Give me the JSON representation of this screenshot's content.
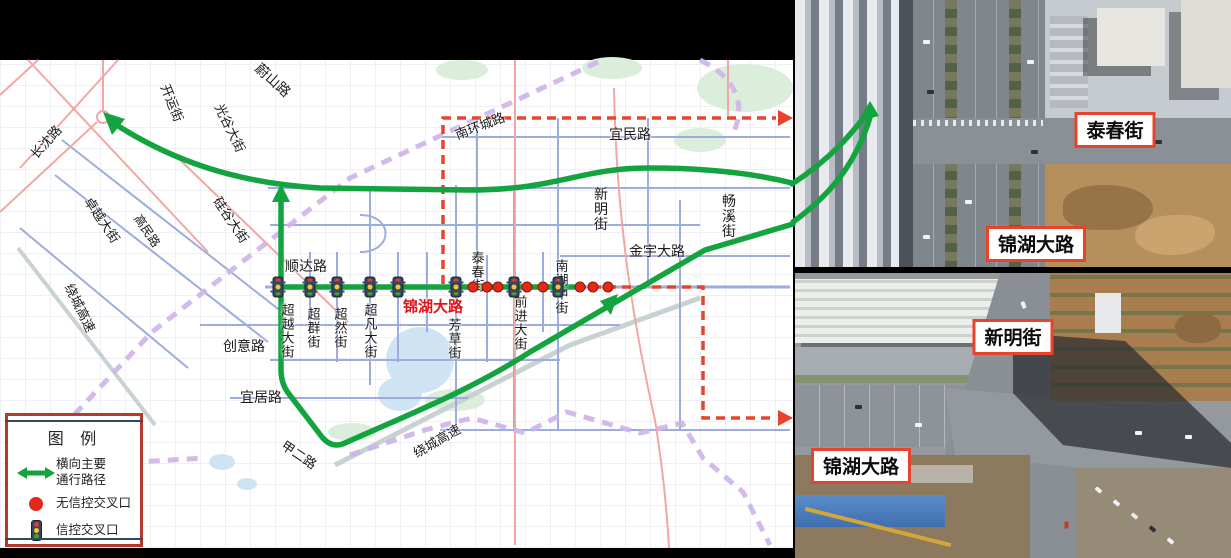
{
  "colors": {
    "route_green": "#13a43f",
    "dashed_red": "#e8432c",
    "corridor_red": "#e31219",
    "legend_border": "#b43a2c",
    "uncontrolled_dot": "#e12a17"
  },
  "legend": {
    "title": "图 例",
    "items": [
      {
        "icon": "double-arrow",
        "label": "横向主要\n通行路径"
      },
      {
        "icon": "red-dot",
        "label": "无信控交叉口"
      },
      {
        "icon": "traffic-light",
        "label": "信控交叉口"
      }
    ]
  },
  "map": {
    "corridor_name": "锦湖大路",
    "labels": [
      {
        "t": "蔚山路",
        "x": 273,
        "y": 80,
        "m": "r",
        "r": 42,
        "s": 14
      },
      {
        "t": "开运街",
        "x": 172,
        "y": 103,
        "m": "r",
        "r": 68,
        "s": 13
      },
      {
        "t": "光谷大街",
        "x": 230,
        "y": 128,
        "m": "r",
        "r": 64,
        "s": 13
      },
      {
        "t": "长沈路",
        "x": 46,
        "y": 142,
        "m": "r",
        "r": -48,
        "s": 13
      },
      {
        "t": "卓越大街",
        "x": 102,
        "y": 220,
        "m": "r",
        "r": 56,
        "s": 13
      },
      {
        "t": "高民路",
        "x": 147,
        "y": 231,
        "m": "r",
        "r": 56,
        "s": 12
      },
      {
        "t": "硅谷大街",
        "x": 231,
        "y": 220,
        "m": "r",
        "r": 56,
        "s": 13
      },
      {
        "t": "绕城高速",
        "x": 80,
        "y": 308,
        "m": "r",
        "r": 64,
        "s": 13
      },
      {
        "t": "顺达路",
        "x": 306,
        "y": 266,
        "m": "h",
        "s": 14
      },
      {
        "t": "创意路",
        "x": 244,
        "y": 346,
        "m": "h",
        "s": 14
      },
      {
        "t": "宜居路",
        "x": 261,
        "y": 397,
        "m": "h",
        "s": 14
      },
      {
        "t": "甲二路",
        "x": 299,
        "y": 455,
        "m": "r",
        "r": 34,
        "s": 13
      },
      {
        "t": "超越大街",
        "x": 287,
        "y": 331,
        "m": "v",
        "s": 13
      },
      {
        "t": "超群街",
        "x": 313,
        "y": 328,
        "m": "v",
        "s": 13
      },
      {
        "t": "超然街",
        "x": 340,
        "y": 328,
        "m": "v",
        "s": 13
      },
      {
        "t": "超凡大街",
        "x": 370,
        "y": 331,
        "m": "v",
        "s": 13
      },
      {
        "t": "芳草街",
        "x": 454,
        "y": 339,
        "m": "v",
        "s": 13
      },
      {
        "t": "泰春街",
        "x": 477,
        "y": 272,
        "m": "v",
        "s": 13
      },
      {
        "t": "前进大街",
        "x": 520,
        "y": 323,
        "m": "v",
        "s": 13
      },
      {
        "t": "南湖中街",
        "x": 561,
        "y": 287,
        "m": "v",
        "s": 13
      },
      {
        "t": "新明街",
        "x": 601,
        "y": 209,
        "m": "v",
        "s": 14
      },
      {
        "t": "宜民路",
        "x": 630,
        "y": 134,
        "m": "h",
        "s": 14
      },
      {
        "t": "南环城路",
        "x": 480,
        "y": 126,
        "m": "r",
        "r": -21,
        "s": 13
      },
      {
        "t": "金宇大路",
        "x": 657,
        "y": 251,
        "m": "h",
        "s": 14
      },
      {
        "t": "畅溪街",
        "x": 729,
        "y": 216,
        "m": "v",
        "s": 14
      },
      {
        "t": "绕城高速",
        "x": 437,
        "y": 441,
        "m": "r",
        "r": -30,
        "s": 13
      },
      {
        "t": "锦湖大路",
        "x": 433,
        "y": 307,
        "m": "h",
        "s": 15,
        "c": "#e31219",
        "b": 1
      }
    ],
    "signals": {
      "y": 287,
      "x": [
        278,
        310,
        337,
        370,
        398,
        456,
        514,
        558
      ]
    },
    "uncontrolled": {
      "y": 287,
      "x": [
        473,
        487,
        498,
        527,
        543,
        580,
        593,
        608
      ]
    }
  },
  "photos": [
    {
      "name": "taichun-street-aerial",
      "labels": [
        {
          "t": "泰春街",
          "x": 1115,
          "y": 130
        },
        {
          "t": "锦湖大路",
          "x": 1036,
          "y": 244
        }
      ]
    },
    {
      "name": "xinming-street-aerial",
      "labels": [
        {
          "t": "新明街",
          "x": 1013,
          "y": 337
        },
        {
          "t": "锦湖大路",
          "x": 861,
          "y": 466
        }
      ]
    }
  ]
}
